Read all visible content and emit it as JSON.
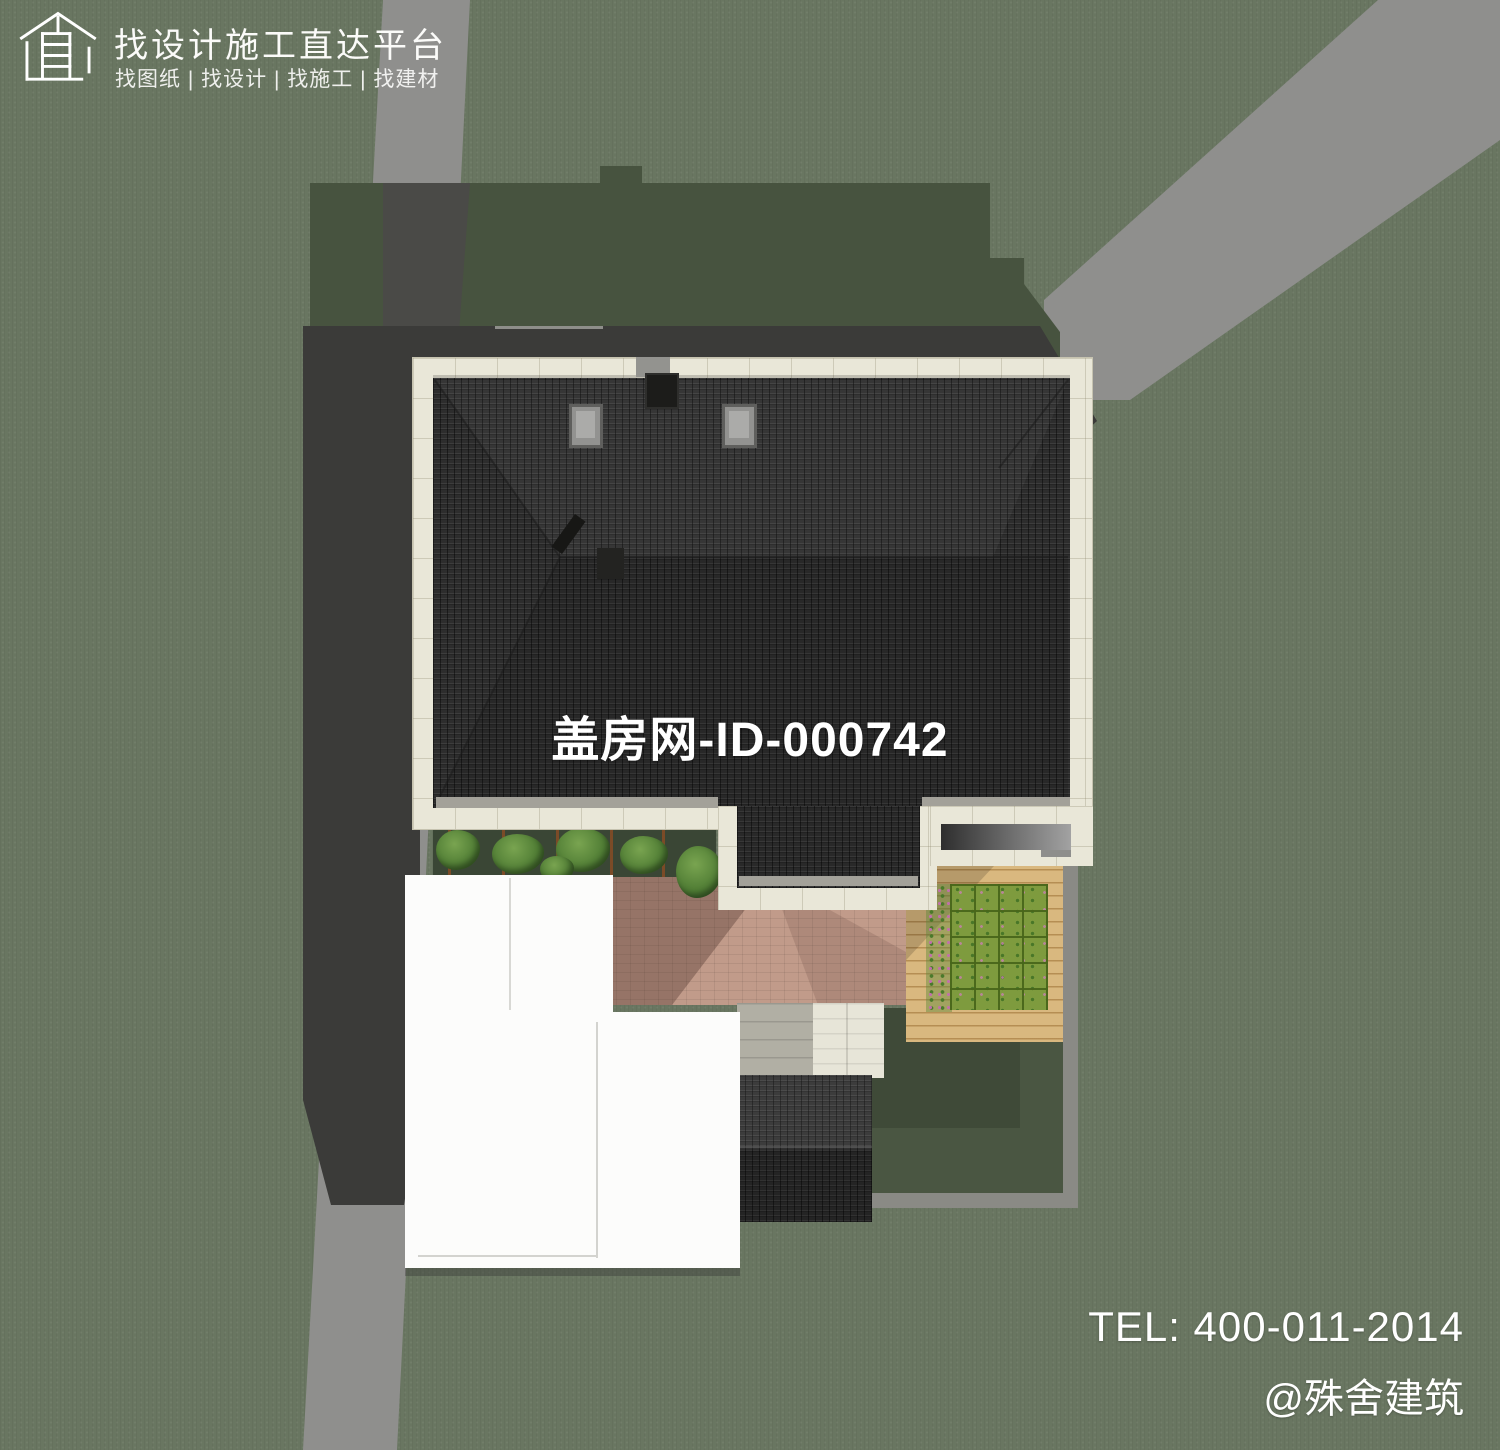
{
  "branding": {
    "logo_icon": "house-outline-logo-icon",
    "title": "找设计施工直达平台",
    "subtitle": "找图纸 | 找设计 | 找施工 | 找建材"
  },
  "watermark": {
    "site_id": "盖房网-ID-000742"
  },
  "contact": {
    "tel": "TEL: 400-011-2014",
    "handle": "@殊舍建筑"
  },
  "palette": {
    "grass": "#697661",
    "shadow_green": "#47533f",
    "shadow_grey": "#3b3b39",
    "road": "#8f8f8d",
    "road_shadowed": "#4a4a47",
    "roof": "#2d2d2d",
    "stone": "#e9e7d8",
    "white_roof": "#fcfcfb",
    "paving": "#c19b8a",
    "deck": "#d9b87f",
    "lawn_grid": "#7e9b3e",
    "courtyard_lawn": "#4a5642",
    "wall_grey": "#8a8a85",
    "text": "#ffffff"
  }
}
